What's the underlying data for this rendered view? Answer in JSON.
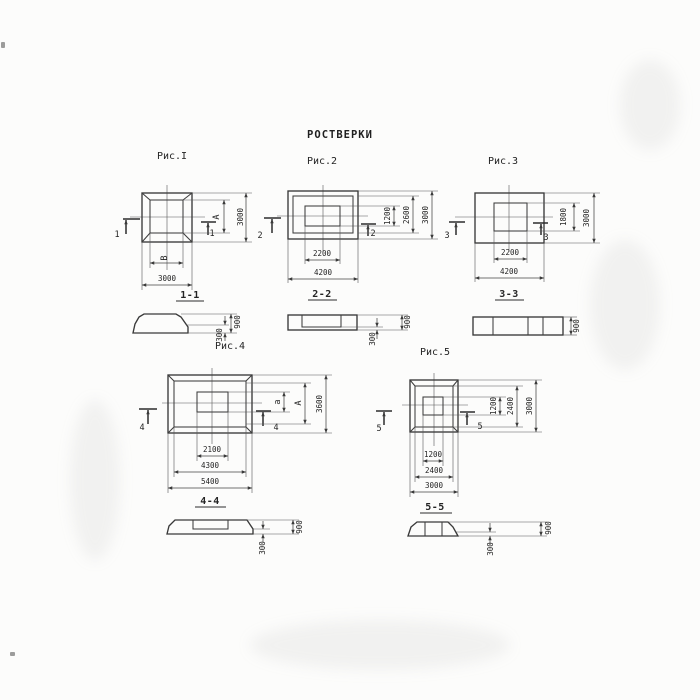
{
  "colors": {
    "ink": "#3a3a3a",
    "paper": "#fcfcfb"
  },
  "title": "РОСТВЕРКИ",
  "fig1": {
    "caption": "Рис.I",
    "cut": "1",
    "section_label": "1-1",
    "dim_width_inner": "В",
    "dim_width_outer": "3000",
    "dim_height_inner": "А",
    "dim_height_outer": "3000"
  },
  "fig2": {
    "caption": "Рис.2",
    "cut": "2",
    "section_label": "2-2",
    "dim_width_inner": "2200",
    "dim_width_outer": "4200",
    "dim_height_1": "1200",
    "dim_height_2": "2600",
    "dim_height_3": "3000"
  },
  "fig3": {
    "caption": "Рис.3",
    "cut": "3",
    "section_label": "3-3",
    "dim_width_inner": "2200",
    "dim_width_outer": "4200",
    "dim_height_inner": "1800",
    "dim_height_outer": "3000"
  },
  "fig4": {
    "caption": "Рис.4",
    "cut": "4",
    "section_label": "4-4",
    "dim_width_1": "2100",
    "dim_width_2": "4300",
    "dim_width_3": "5400",
    "dim_height_1": "а",
    "dim_height_2": "А",
    "dim_height_3": "3600"
  },
  "fig5": {
    "caption": "Рис.5",
    "cut": "5",
    "section_label": "5-5",
    "dim_width_1": "1200",
    "dim_width_2": "2400",
    "dim_width_3": "3000",
    "dim_height_1": "1200",
    "dim_height_2": "2400",
    "dim_height_3": "3000"
  },
  "sec1": {
    "height_total": "900",
    "height_toe": "300"
  },
  "sec2": {
    "height_total": "900",
    "height_toe": "300"
  },
  "sec3": {
    "height_total": "900"
  },
  "sec4": {
    "height_total": "900",
    "height_toe": "300"
  },
  "sec5": {
    "height_total": "900",
    "height_toe": "300"
  }
}
